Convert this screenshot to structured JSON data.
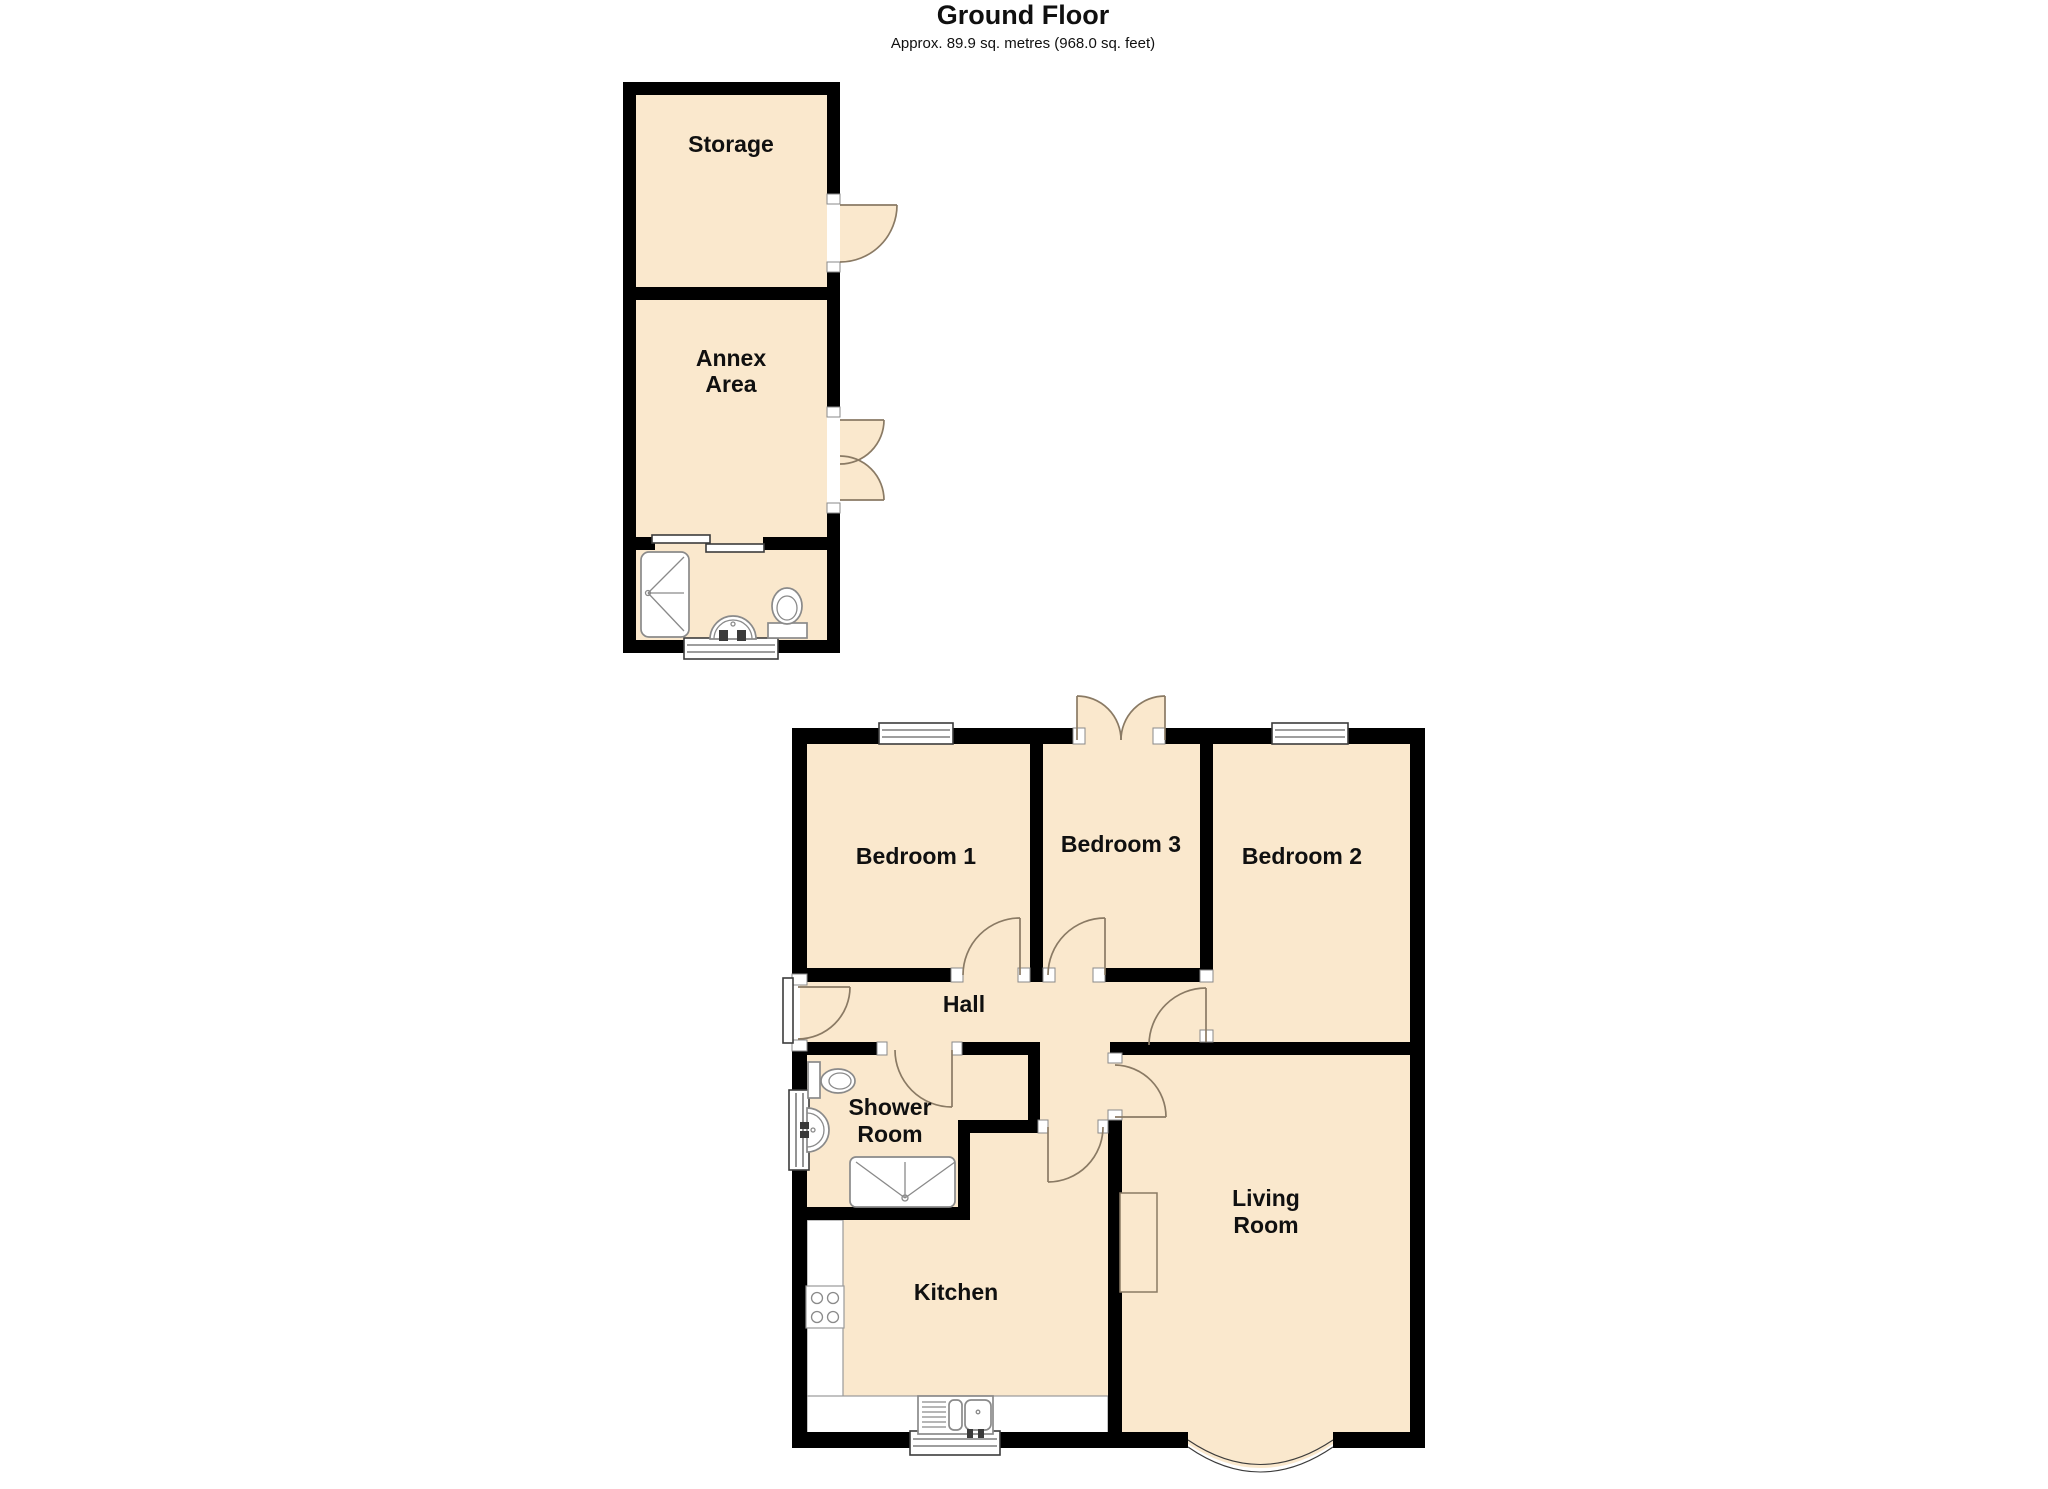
{
  "title": "Ground Floor",
  "subtitle": "Approx. 89.9 sq. metres (968.0 sq. feet)",
  "rooms": {
    "storage": "Storage",
    "annex_line1": "Annex",
    "annex_line2": "Area",
    "bedroom1": "Bedroom 1",
    "bedroom3": "Bedroom 3",
    "bedroom2": "Bedroom 2",
    "hall": "Hall",
    "shower_line1": "Shower",
    "shower_line2": "Room",
    "kitchen": "Kitchen",
    "living_line1": "Living",
    "living_line2": "Room"
  },
  "colors": {
    "floor": "#fae8cd",
    "wall": "#000000",
    "door_arc": "#8a7a64"
  }
}
